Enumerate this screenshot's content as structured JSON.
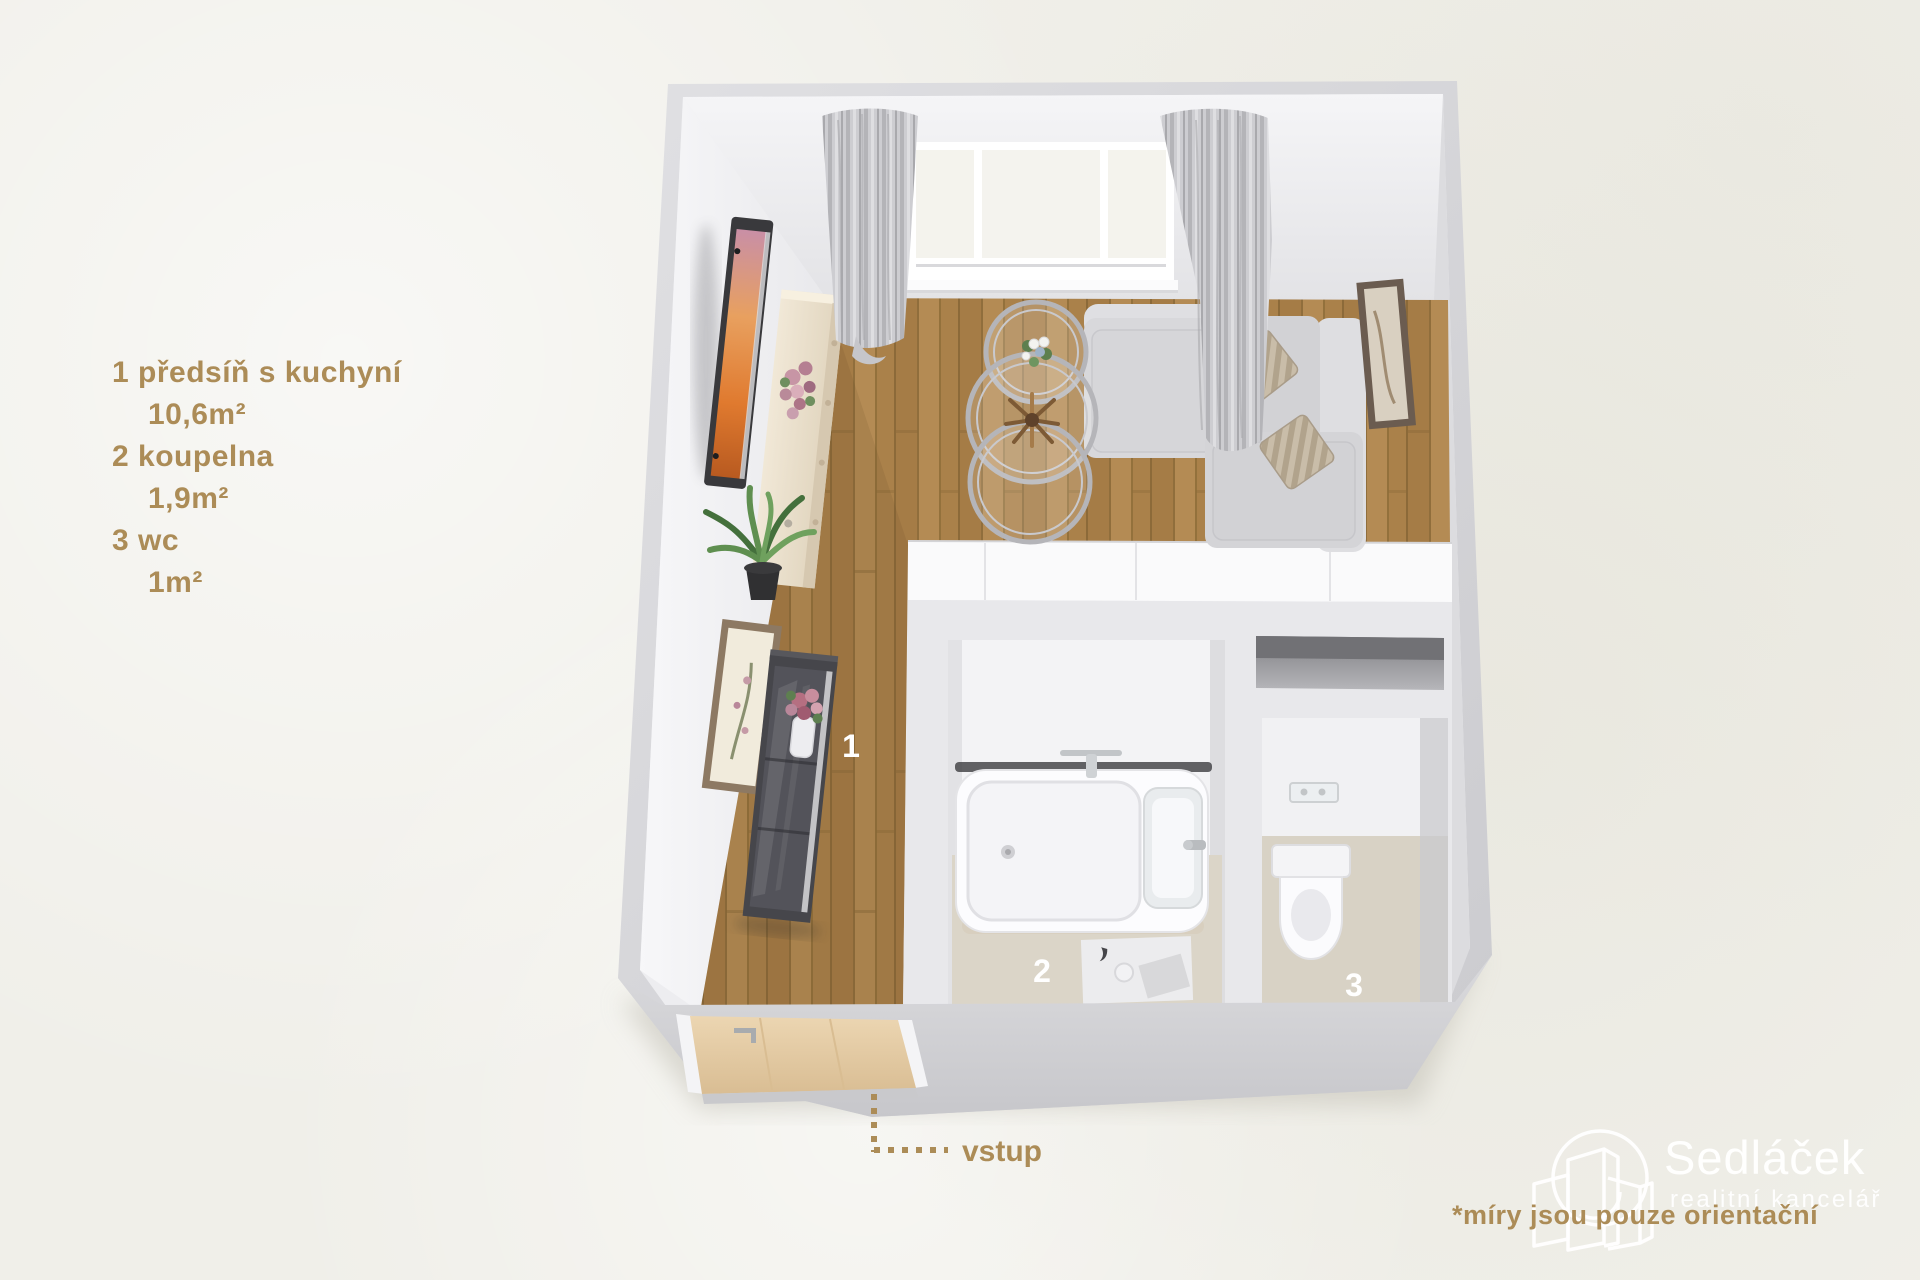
{
  "page": {
    "background_color": "#f0efe9"
  },
  "legend": {
    "accent_color": "#ac8c57",
    "rooms": [
      {
        "number": "1",
        "label": "předsíň s kuchyní",
        "area": "10,6m²"
      },
      {
        "number": "2",
        "label": "koupelna",
        "area": "1,9m²"
      },
      {
        "number": "3",
        "label": "wc",
        "area": "1m²"
      }
    ]
  },
  "floorplan": {
    "room_labels": {
      "room1": "1",
      "room2": "2",
      "room3": "3"
    },
    "colors": {
      "wall_gray": "#d7d7da",
      "wall_face": "#f2f2f4",
      "wood_floor": "#b3894f",
      "bath_tile": "#d9d3c6",
      "label_white": "#ffffff",
      "tv_screen_orange": "#df7a31",
      "door_wood": "#e3c9a1"
    }
  },
  "entrance": {
    "label": "vstup"
  },
  "branding": {
    "name": "Sedláček",
    "tagline": "realitní kancelář",
    "disclaimer": "*míry jsou pouze orientační"
  }
}
